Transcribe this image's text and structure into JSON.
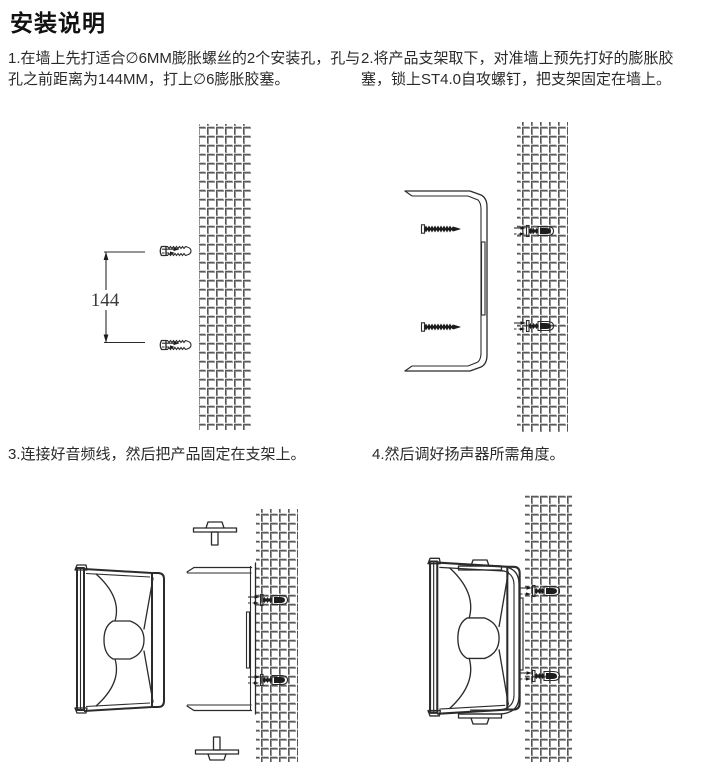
{
  "page": {
    "title": "安装说明"
  },
  "steps": [
    {
      "label": "1.在墙上先打适合∅6MM膨胀螺丝的2个安装孔，孔与孔之前距离为144MM，打上∅6膨胀胶塞。"
    },
    {
      "label": "2.将产品支架取下，对准墙上预先打好的膨胀胶塞，锁上ST4.0自攻螺钉，把支架固定在墙上。"
    },
    {
      "label": "3.连接好音频线，然后把产品固定在支架上。"
    },
    {
      "label": "4.然后调好扬声器所需角度。"
    }
  ],
  "figures": {
    "step1": {
      "dimension_label": "144"
    }
  },
  "icons": {
    "wall_hatch": "masonry-wall-hatch",
    "expansion_anchor": "expansion-anchor-plug",
    "self_tapping_screw": "st4-self-tapping-screw",
    "bracket": "mounting-bracket",
    "thumb_knob": "thumb-screw-knob",
    "speaker": "horn-speaker-side-view"
  },
  "colors": {
    "line": "#2b2b2b",
    "hatch_dark": "#454545",
    "hatch_light": "#9d9d9d",
    "text": "#2a2a2a",
    "background": "#ffffff"
  }
}
